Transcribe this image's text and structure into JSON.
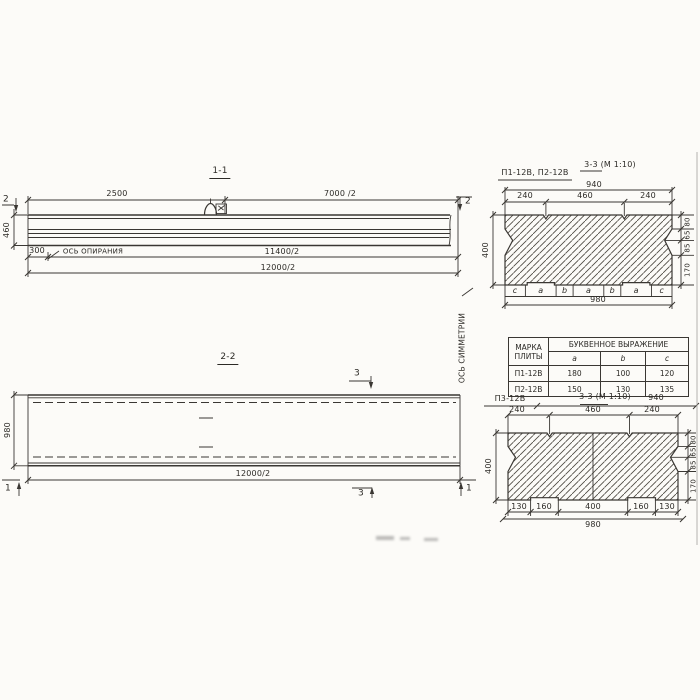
{
  "section_1_1": {
    "title": "1-1",
    "cut_mark": "2",
    "dim_2500": "2500",
    "dim_7000_half": "7000 /2",
    "dim_height": "460",
    "dim_300": "300",
    "support_axis_label": "ОСЬ ОПИРАНИЯ",
    "dim_11400_half": "11400/2",
    "dim_12000_half": "12000/2"
  },
  "section_2_2": {
    "title": "2-2",
    "cut_mark_3": "3",
    "cut_mark_1": "1",
    "dim_width": "980",
    "dim_12000_half": "12000/2"
  },
  "symmetry_axis_label": "ОСЬ СИММЕТРИИ",
  "section_3_3_top": {
    "label": "П1-12В, П2-12В",
    "title": "3-3 (М 1:10)",
    "dim_940": "940",
    "dim_240": "240",
    "dim_460": "460",
    "dim_400": "400",
    "right_dims": [
      "80",
      "65",
      "85",
      "170"
    ],
    "letters": [
      "c",
      "a",
      "b",
      "a",
      "b",
      "a",
      "c"
    ],
    "dim_980": "980"
  },
  "table": {
    "header_mark_line1": "МАРКА",
    "header_mark_line2": "ПЛИТЫ",
    "header_group": "БУКВЕННОЕ  ВЫРАЖЕНИЕ",
    "columns": [
      "a",
      "b",
      "c"
    ],
    "rows": [
      {
        "mark": "П1-12В",
        "a": "180",
        "b": "100",
        "c": "120"
      },
      {
        "mark": "П2-12В",
        "a": "150",
        "b": "130",
        "c": "135"
      }
    ]
  },
  "section_3_3_bottom": {
    "label": "П3-12В",
    "title": "3-3 (М 1:10)",
    "dim_940": "940",
    "dim_240": "240",
    "dim_460": "460",
    "dim_400": "400",
    "right_dims": [
      "80",
      "65",
      "85",
      "170"
    ],
    "bottom_dims": [
      "130",
      "160",
      "400",
      "160",
      "130"
    ],
    "dim_980": "980"
  }
}
